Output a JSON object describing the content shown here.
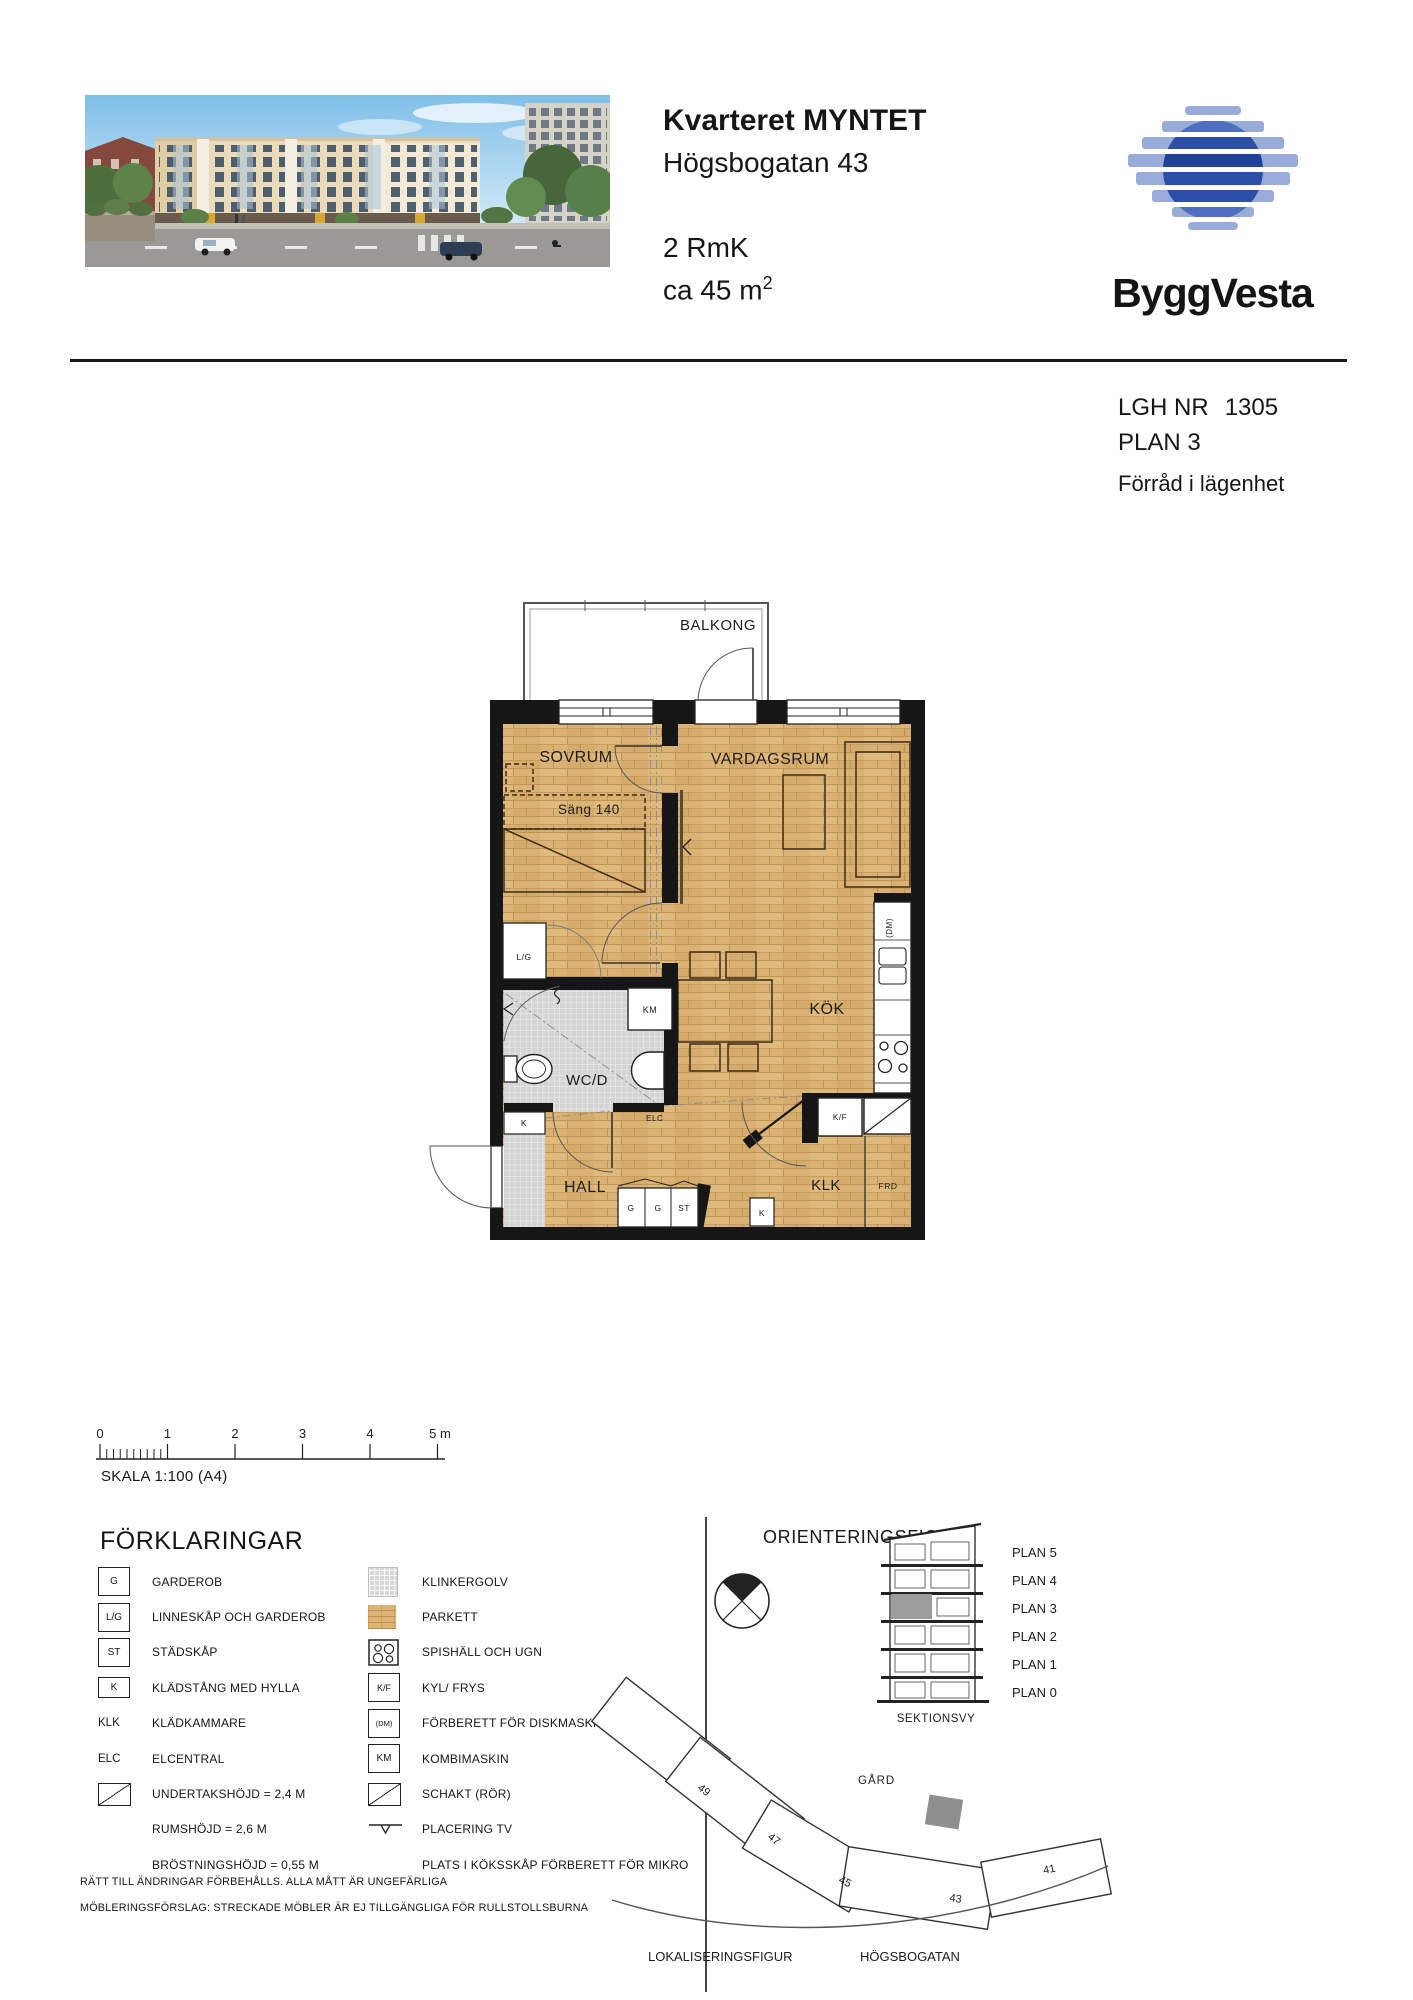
{
  "header": {
    "title": "Kvarteret MYNTET",
    "address": "Högsbogatan 43",
    "rooms": "2 RmK",
    "area": "ca 45 m",
    "area_sup": "2",
    "brand": "ByggVesta"
  },
  "info": {
    "lgh_label": "LGH NR",
    "lgh_value": "1305",
    "plan": "PLAN 3",
    "note": "Förråd i lägenhet"
  },
  "plan_labels": {
    "balkong": "BALKONG",
    "sovrum": "SOVRUM",
    "vardagsrum": "VARDAGSRUM",
    "sang": "Säng 140",
    "lg": "L/G",
    "km": "KM",
    "wcd": "WC/D",
    "elc": "ELC",
    "hall": "HALL",
    "g1": "G",
    "g2": "G",
    "st": "ST",
    "k_hall": "K",
    "kok": "KÖK",
    "kf": "K/F",
    "dm": "(DM)",
    "klk": "KLK",
    "frd": "FRD",
    "k_klk": "K"
  },
  "scalebar": {
    "ticks": [
      "0",
      "1",
      "2",
      "3",
      "4",
      "5 m"
    ],
    "label": "SKALA 1:100 (A4)"
  },
  "legend": {
    "title": "FÖRKLARINGAR",
    "left": [
      {
        "symbol": "G",
        "label": "GARDEROB"
      },
      {
        "symbol": "L/G",
        "label": "LINNESKÅP OCH GARDEROB"
      },
      {
        "symbol": "ST",
        "label": "STÄDSKÅP"
      },
      {
        "symbol": "K",
        "label": "KLÄDSTÅNG MED HYLLA"
      },
      {
        "symbol": "KLK",
        "label": "KLÄDKAMMARE"
      },
      {
        "symbol": "ELC",
        "label": "ELCENTRAL"
      },
      {
        "symbol": "",
        "label": "UNDERTAKSHÖJD = 2,4 M"
      },
      {
        "symbol": "",
        "label": "RUMSHÖJD = 2,6 M"
      },
      {
        "symbol": "",
        "label": "BRÖSTNINGSHÖJD = 0,55 M"
      }
    ],
    "right": [
      {
        "symbol": "",
        "label": "KLINKERGOLV"
      },
      {
        "symbol": "",
        "label": "PARKETT"
      },
      {
        "symbol": "",
        "label": "SPISHÄLL OCH UGN"
      },
      {
        "symbol": "K/F",
        "label": "KYL/ FRYS"
      },
      {
        "symbol": "(DM)",
        "label": "FÖRBERETT FÖR DISKMASKIN"
      },
      {
        "symbol": "KM",
        "label": "KOMBIMASKIN"
      },
      {
        "symbol": "",
        "label": "SCHAKT (RÖR)"
      },
      {
        "symbol": "",
        "label": "PLACERING TV"
      },
      {
        "symbol": "",
        "label": "PLATS I KÖKSSKÅP FÖRBERETT FÖR MIKRO"
      }
    ],
    "notes": [
      "RÄTT TILL ÄNDRINGAR FÖRBEHÅLLS. ALLA MÅTT ÄR UNGEFÄRLIGA",
      "MÖBLERINGSFÖRSLAG: STRECKADE MÖBLER ÄR EJ TILLGÄNGLIGA FÖR RULLSTOLLSBURNA"
    ]
  },
  "orientation": {
    "title": "ORIENTERINGSFIGUR",
    "plans": [
      "PLAN 5",
      "PLAN 4",
      "PLAN 3",
      "PLAN 2",
      "PLAN 1",
      "PLAN 0"
    ],
    "sektionsvy": "SEKTIONSVY",
    "gard": "GÅRD",
    "numbers": [
      "49",
      "47",
      "45",
      "43",
      "41"
    ],
    "lokalisering": "LOKALISERINGSFIGUR",
    "street": "HÖGSBOGATAN"
  },
  "colors": {
    "brand_blue_dark": "#2a4fa4",
    "brand_blue_light": "#98abd9",
    "parquet": "#dab273",
    "klinker": "#d4d4d4",
    "wall": "#161616"
  }
}
